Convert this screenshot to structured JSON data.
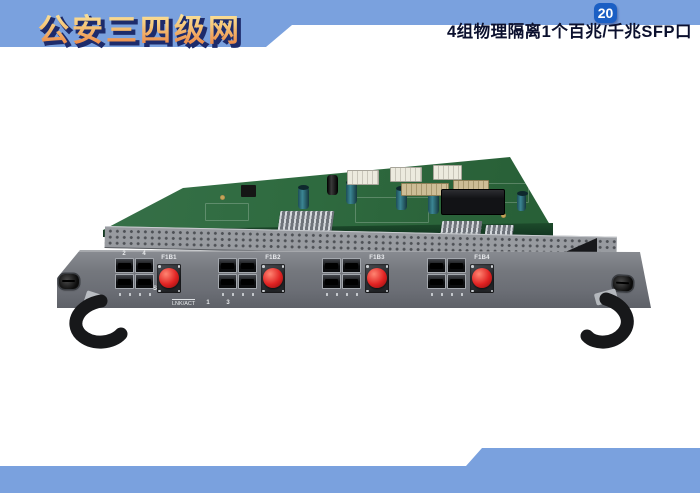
{
  "colors": {
    "ribbon_blue": "#7aa1de",
    "badge_blue": "#1b5fc4",
    "title_gradient_top": "#fdf4b4",
    "title_gradient_bottom": "#e8763a",
    "title_shadow": "#1d2b6b",
    "caption_text": "#0b102e",
    "pcb_green": "#2f6b40",
    "faceplate_gray": "#75787e",
    "coupler_red": "#e02222"
  },
  "header": {
    "title": "公安三四级网",
    "page_number": "20"
  },
  "footer": {
    "caption": "4组物理隔离1个百兆/千兆SFP口"
  },
  "device": {
    "panel_labels": {
      "sys": "SYS",
      "link": "LNK/ACT"
    },
    "port_numbers": {
      "top": [
        "2",
        "4"
      ],
      "bottom": [
        "1",
        "3"
      ]
    },
    "couplers": [
      "F1B1",
      "F1B2",
      "F1B3",
      "F1B4"
    ]
  }
}
